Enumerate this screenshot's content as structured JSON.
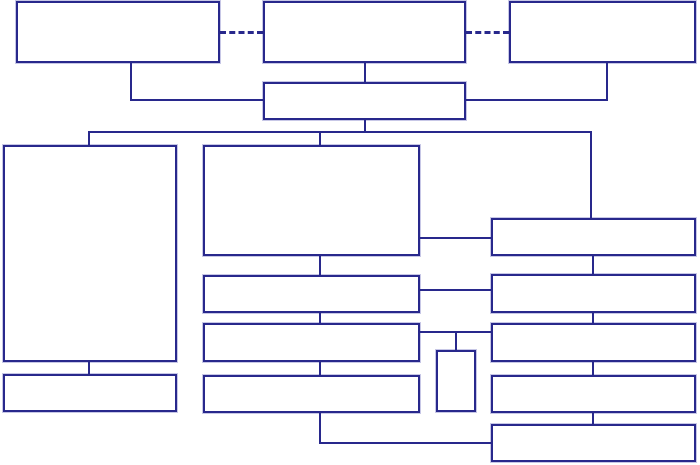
{
  "diagram": {
    "type": "flowchart",
    "title": "",
    "canvas": {
      "width": 700,
      "height": 465,
      "background": "#ffffff"
    },
    "style": {
      "line_color": "#28288C",
      "line_width": 2,
      "box_fill": "#ffffff",
      "dashed_style": "dashed",
      "solid_style": "solid"
    },
    "nodes": [
      {
        "id": "top-left",
        "label": "",
        "x": 16,
        "y": 1,
        "w": 204,
        "h": 62
      },
      {
        "id": "top-center",
        "label": "",
        "x": 263,
        "y": 1,
        "w": 203,
        "h": 62
      },
      {
        "id": "top-right",
        "label": "",
        "x": 509,
        "y": 1,
        "w": 187,
        "h": 62
      },
      {
        "id": "level2-center",
        "label": "",
        "x": 263,
        "y": 82,
        "w": 203,
        "h": 38
      },
      {
        "id": "left-tall",
        "label": "",
        "x": 3,
        "y": 145,
        "w": 174,
        "h": 217
      },
      {
        "id": "left-bottom",
        "label": "",
        "x": 3,
        "y": 374,
        "w": 174,
        "h": 38
      },
      {
        "id": "mid-large",
        "label": "",
        "x": 203,
        "y": 145,
        "w": 217,
        "h": 111
      },
      {
        "id": "mid-row2",
        "label": "",
        "x": 203,
        "y": 275,
        "w": 217,
        "h": 38
      },
      {
        "id": "mid-row3",
        "label": "",
        "x": 203,
        "y": 323,
        "w": 217,
        "h": 39
      },
      {
        "id": "mid-row4",
        "label": "",
        "x": 203,
        "y": 375,
        "w": 217,
        "h": 38
      },
      {
        "id": "small-center",
        "label": "",
        "x": 436,
        "y": 350,
        "w": 40,
        "h": 62
      },
      {
        "id": "right-row1",
        "label": "",
        "x": 491,
        "y": 218,
        "w": 205,
        "h": 38
      },
      {
        "id": "right-row2",
        "label": "",
        "x": 491,
        "y": 274,
        "w": 205,
        "h": 39
      },
      {
        "id": "right-row3",
        "label": "",
        "x": 491,
        "y": 323,
        "w": 205,
        "h": 39
      },
      {
        "id": "right-row4",
        "label": "",
        "x": 491,
        "y": 375,
        "w": 205,
        "h": 38
      },
      {
        "id": "right-row5",
        "label": "",
        "x": 491,
        "y": 424,
        "w": 205,
        "h": 38
      }
    ],
    "edges": [
      {
        "id": "dash-topleft-topcenter",
        "style": "dashed",
        "segments": [
          [
            220,
            31,
            43,
            3
          ]
        ]
      },
      {
        "id": "dash-topcenter-topright",
        "style": "dashed",
        "segments": [
          [
            466,
            31,
            43,
            3
          ]
        ]
      },
      {
        "id": "topleft-to-level2",
        "style": "solid",
        "segments": [
          [
            130,
            63,
            2,
            38
          ],
          [
            130,
            99,
            135,
            2
          ]
        ]
      },
      {
        "id": "topcenter-to-level2",
        "style": "solid",
        "segments": [
          [
            364,
            63,
            2,
            19
          ]
        ]
      },
      {
        "id": "topright-to-level2",
        "style": "solid",
        "segments": [
          [
            606,
            62,
            2,
            39
          ],
          [
            465,
            99,
            143,
            2
          ]
        ]
      },
      {
        "id": "level2-to-bus",
        "style": "solid",
        "segments": [
          [
            364,
            120,
            2,
            13
          ]
        ]
      },
      {
        "id": "main-bus",
        "style": "solid",
        "segments": [
          [
            88,
            131,
            504,
            2
          ]
        ]
      },
      {
        "id": "bus-to-left-tall",
        "style": "solid",
        "segments": [
          [
            88,
            131,
            2,
            15
          ]
        ]
      },
      {
        "id": "bus-to-mid-large",
        "style": "solid",
        "segments": [
          [
            319,
            131,
            2,
            15
          ]
        ]
      },
      {
        "id": "bus-to-right1",
        "style": "solid",
        "segments": [
          [
            590,
            131,
            2,
            88
          ]
        ]
      },
      {
        "id": "midlarge-to-right1",
        "style": "solid",
        "segments": [
          [
            420,
            237,
            72,
            2
          ]
        ]
      },
      {
        "id": "midlarge-to-mid2",
        "style": "solid",
        "segments": [
          [
            319,
            256,
            2,
            19
          ]
        ]
      },
      {
        "id": "mid2-to-mid3",
        "style": "solid",
        "segments": [
          [
            319,
            313,
            2,
            10
          ]
        ]
      },
      {
        "id": "mid3-to-mid4",
        "style": "solid",
        "segments": [
          [
            319,
            362,
            2,
            13
          ]
        ]
      },
      {
        "id": "mid2-to-right2",
        "style": "solid",
        "segments": [
          [
            420,
            289,
            71,
            2
          ]
        ]
      },
      {
        "id": "mid3-to-right3",
        "style": "solid",
        "segments": [
          [
            420,
            331,
            71,
            2
          ]
        ]
      },
      {
        "id": "right3link-to-small",
        "style": "solid",
        "segments": [
          [
            455,
            331,
            2,
            19
          ]
        ]
      },
      {
        "id": "lefttall-to-leftbottom",
        "style": "solid",
        "segments": [
          [
            88,
            362,
            2,
            12
          ]
        ]
      },
      {
        "id": "mid4-to-right5",
        "style": "solid",
        "segments": [
          [
            319,
            413,
            2,
            31
          ],
          [
            319,
            442,
            174,
            2
          ]
        ]
      },
      {
        "id": "right1-to-right2",
        "style": "solid",
        "segments": [
          [
            592,
            256,
            2,
            18
          ]
        ]
      },
      {
        "id": "right2-to-right3",
        "style": "solid",
        "segments": [
          [
            592,
            313,
            2,
            10
          ]
        ]
      },
      {
        "id": "right3-to-right4",
        "style": "solid",
        "segments": [
          [
            592,
            362,
            2,
            13
          ]
        ]
      },
      {
        "id": "right4-to-right5",
        "style": "solid",
        "segments": [
          [
            592,
            413,
            2,
            11
          ]
        ]
      }
    ]
  }
}
